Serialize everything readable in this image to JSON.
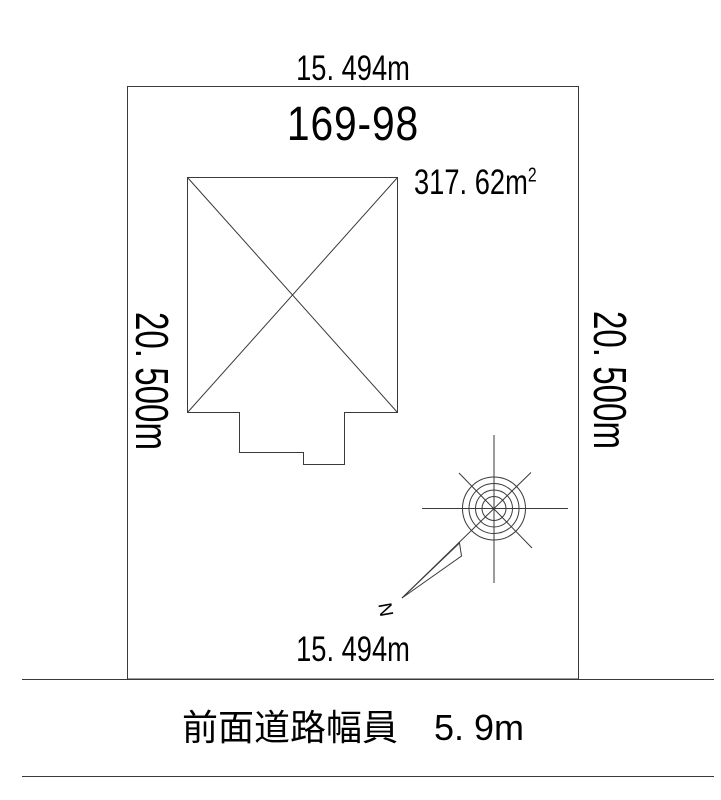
{
  "labels": {
    "dim_top": "15. 494m",
    "dim_bottom": "15. 494m",
    "dim_left": "20. 500m",
    "dim_right": "20. 500m",
    "parcel_number": "169-98",
    "area_value": "317. 62m",
    "area_exponent": "2",
    "north": "N",
    "road": "前面道路幅員　5. 9m"
  },
  "colors": {
    "line": "#3a3a3a",
    "text": "#000000",
    "background": "#ffffff"
  },
  "icons": {
    "compass": "compass-rose-icon",
    "north_arrow": "north-arrow-icon"
  }
}
